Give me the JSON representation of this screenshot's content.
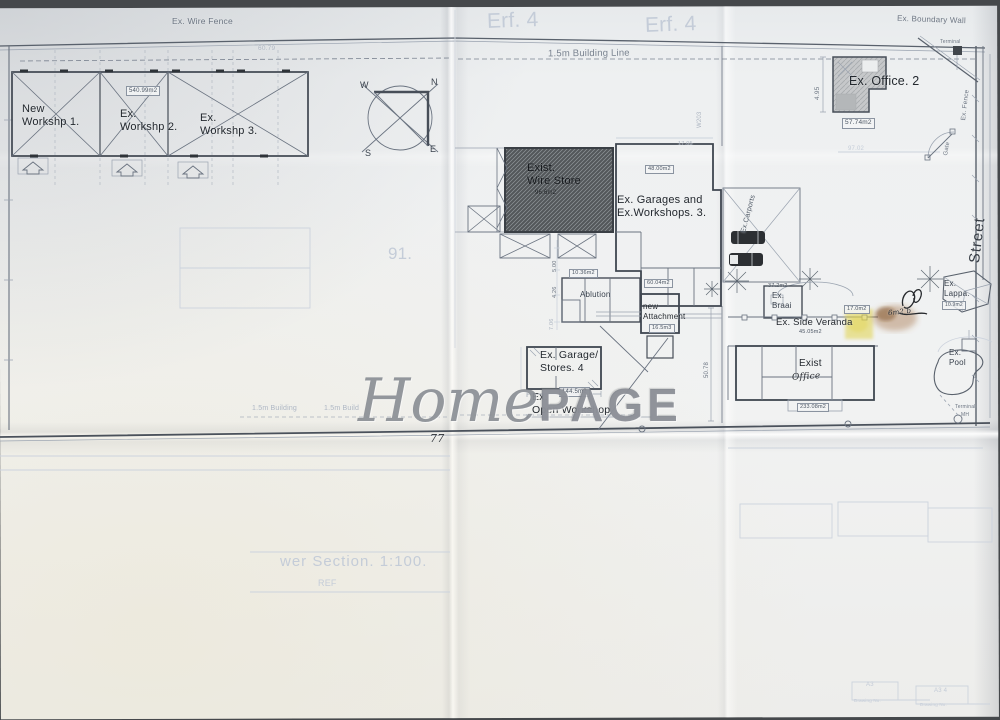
{
  "document": {
    "type": "scanned site plan",
    "sheet": "Erf 4 site layout"
  },
  "watermark": {
    "script": "Home",
    "caps": "PAGE"
  },
  "colors": {
    "paper": "#eef0f1",
    "ink": "#6a7380",
    "wall_ink": "#3f4650",
    "faint": "#c4ccd8",
    "highlight": "#e0d149",
    "stain": "#9b6430",
    "watermark": "#7c8189",
    "hatch_dark": "#53575a"
  },
  "compass": {
    "n": "N",
    "s": "S",
    "e": "E",
    "w": "W"
  },
  "labels": {
    "ex_wire_fence": "Ex. Wire Fence",
    "erf4_a": "Erf. 4",
    "erf4_b": "Erf. 4",
    "ex_boundary_wall": "Ex. Boundary Wall",
    "dim_6079": "60.79",
    "building_line": "1.5m Building Line",
    "new_workshop_1": "New\nWorkshp 1.",
    "ex_workshop_2": "Ex.\nWorkshp 2.",
    "ex_workshop_3": "Ex.\nWorkshp 3.",
    "area_540": "540.99m2",
    "w203": "W203",
    "ex_office_2": "Ex. Office. 2",
    "area_5774": "57.74m2",
    "terminal_top": "Terminal",
    "dim_495": "4.95",
    "dim_9702": "97.02",
    "ex_fence": "Ex. Fence",
    "gate": "Gate",
    "exist_wire_store": "Exist.\nWire Store",
    "area_966": "96.6m2",
    "ex_garages": "Ex. Garages and\nEx.Workshops. 3.",
    "area_48": "48.00m2",
    "dim_1705": "17.05",
    "ex_carports": "Ex.Carports",
    "ablution": "Ablution",
    "area_1036": "10.36m2",
    "area_6004": "60.04m2",
    "new_attachment": "new\nAttachment",
    "vol_165": "16.5m3",
    "dim_500": "5.00",
    "dim_426": "4.26",
    "dim_706": "7.06",
    "dim_5078": "50.78",
    "area_372": "37.2m2",
    "ex_braai": "Ex.\nBraai",
    "ex_side_veranda": "Ex. Side Veranda",
    "area_4505": "45.05m2",
    "ex_lappa": "Ex.\nLappa.",
    "area_109": "10.9m2",
    "hand_6m2": "6m2 b",
    "area_170": "17.0m2",
    "ex_garage_stores": "Ex. Garage/\nStores. 4",
    "area_1445": "144.5m2",
    "ex_open_workshop": "Ex.\nOpen Workshop",
    "exist_label": "Exist",
    "office_hand": "Office",
    "area_2330": "233.08m2",
    "ex_pool": "Ex.\nPool",
    "terminal_bottom": "Terminal",
    "mh": "MH",
    "street": "Street",
    "building_15a": "1.5m Building",
    "building_15b": "1.5m Build",
    "hand_77": "77",
    "faint_91": "91.",
    "sewer_section": "wer Section. 1:100.",
    "ref_faint": "REF",
    "a3_a": "A3",
    "drawing_no_a": "Drawing No.",
    "a3_b": "A3 4",
    "drawing_no_b": "Drawing No."
  }
}
